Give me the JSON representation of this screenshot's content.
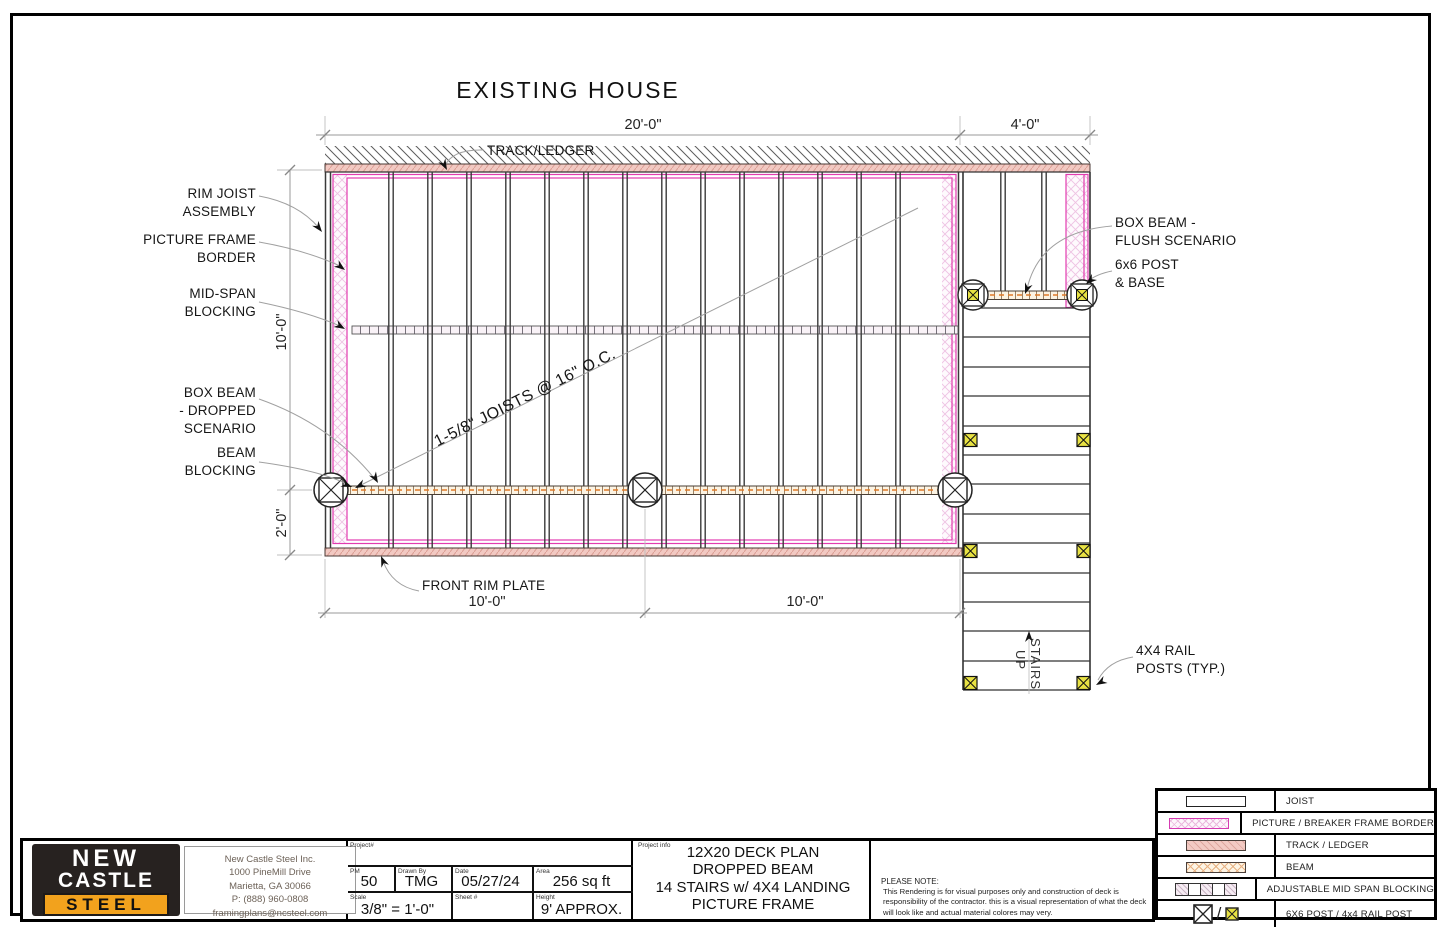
{
  "drawing": {
    "title": "EXISTING HOUSE",
    "joist_note": "1-5/8\" JOISTS @ 16\" O.C.",
    "dims": {
      "top_main": "20'-0\"",
      "top_landing": "4'-0\"",
      "left_upper": "10'-0\"",
      "left_lower": "2'-0\"",
      "bottom_left": "10'-0\"",
      "bottom_right": "10'-0\""
    },
    "labels": {
      "track_ledger": "TRACK/LEDGER",
      "rim_joist_1": "RIM JOIST",
      "rim_joist_2": "ASSEMBLY",
      "picture_1": "PICTURE FRAME",
      "picture_2": "BORDER",
      "midspan_1": "MID-SPAN",
      "midspan_2": "BLOCKING",
      "boxbeam_1": "BOX BEAM",
      "boxbeam_2": "- DROPPED",
      "boxbeam_3": "SCENARIO",
      "beamblock_1": "BEAM",
      "beamblock_2": "BLOCKING",
      "front_rim": "FRONT RIM PLATE",
      "flush_1": "BOX BEAM -",
      "flush_2": "FLUSH SCENARIO",
      "post_1": "6x6 POST",
      "post_2": "& BASE",
      "rail_1": "4X4 RAIL",
      "rail_2": "POSTS (TYP.)",
      "stairs_1": "STAIRS",
      "stairs_2": "UP"
    }
  },
  "title_block": {
    "logo": {
      "line1": "NEW",
      "line2": "CASTLE",
      "line3": "STEEL"
    },
    "company": {
      "name": "New Castle Steel Inc.",
      "address1": "1000 PineMill Drive",
      "address2": "Marietta, GA 30066",
      "phone": "P: (888) 960-0808",
      "email": "framingplans@ncsteel.com"
    },
    "fields": {
      "project_label": "Project#",
      "project_value": "",
      "pm_label": "PM",
      "pm_value": "50",
      "drawn_label": "Drawn By",
      "drawn_value": "TMG",
      "date_label": "Date",
      "date_value": "05/27/24",
      "area_label": "Area",
      "area_value": "256 sq ft",
      "scale_label": "Scale",
      "scale_value": "3/8\" = 1'-0\"",
      "sheet_label": "Sheet #",
      "sheet_value": "",
      "height_label": "Height",
      "height_value": "9' APPROX."
    },
    "project_info": {
      "label": "Project info",
      "line1": "12X20 DECK PLAN",
      "line2": "DROPPED BEAM",
      "line3": "14 STAIRS w/ 4X4 LANDING",
      "line4": "PICTURE FRAME"
    },
    "note": {
      "heading": "PLEASE NOTE:",
      "body": "This Rendering is for visual purposes only and construction of deck is responsibility of the contractor. this is a visual representation of what the deck will look like and actual material colores may very."
    }
  },
  "legend": {
    "rows": [
      {
        "label": "JOIST"
      },
      {
        "label": "PICTURE / BREAKER FRAME BORDER"
      },
      {
        "label": "TRACK / LEDGER"
      },
      {
        "label": "BEAM"
      },
      {
        "label": "ADJUSTABLE MID SPAN BLOCKING"
      },
      {
        "label": "6X6 POST / 4x4 RAIL POST"
      }
    ]
  },
  "colors": {
    "magenta": "#e23bb0",
    "ledger_fill": "#f3cbc5",
    "beam_orange": "#e07b28",
    "post_yellow": "#e8e243",
    "logo_orange": "#f2a21d",
    "logo_dark": "#272220"
  }
}
